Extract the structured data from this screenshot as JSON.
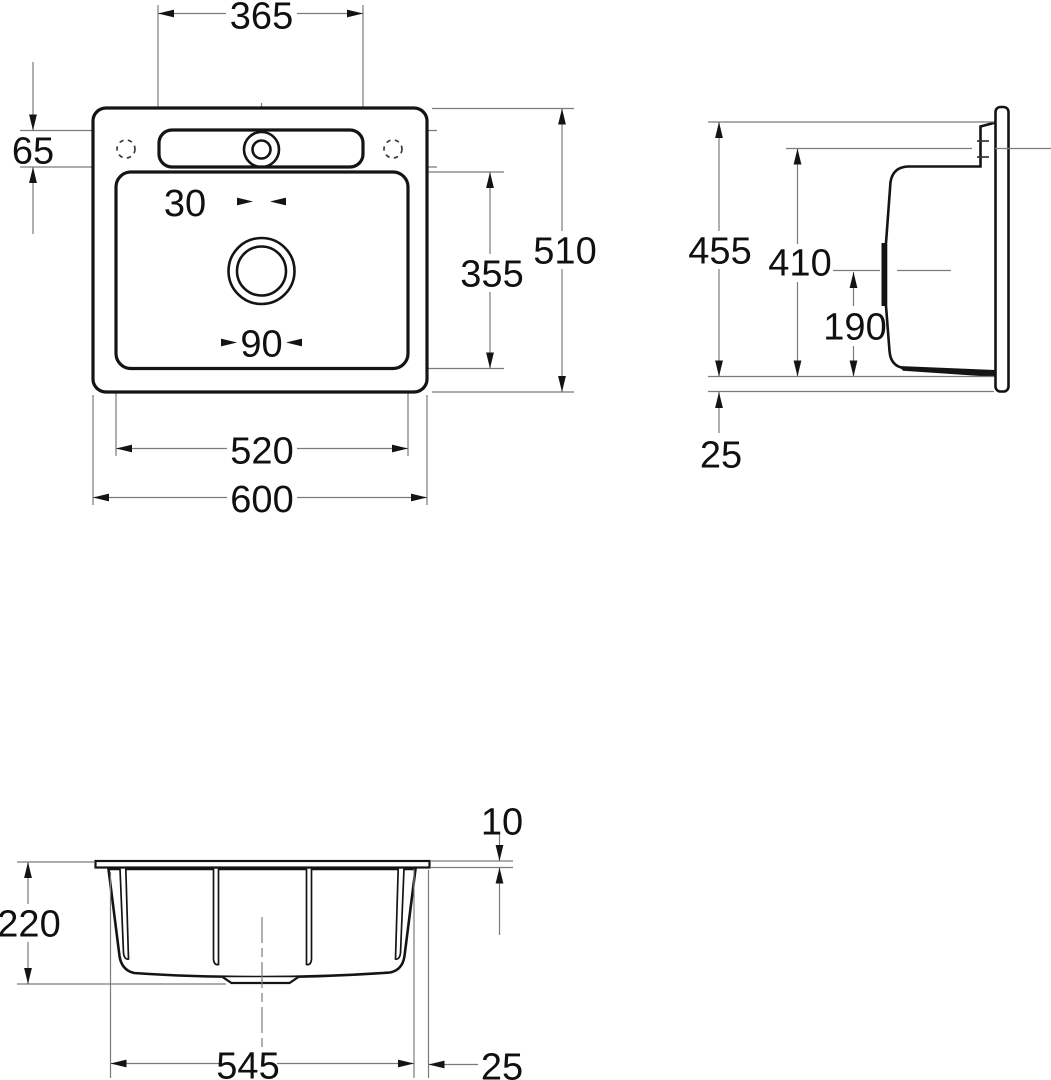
{
  "drawing": {
    "kind": "sink-installation-dimension-drawing",
    "views": {
      "plan": {
        "dims": {
          "deck_cutout_width": "365",
          "deck_depth": "65",
          "tap_hole_diameter": "30",
          "bowl_depth": "355",
          "overall_depth": "510",
          "waste_hole_diameter": "90",
          "bowl_width": "520",
          "overall_width": "600"
        }
      },
      "side": {
        "dims": {
          "overall_height": "455",
          "deck_height": "410",
          "waste_axis_height": "190",
          "flange_bottom_offset": "25"
        }
      },
      "front": {
        "dims": {
          "rim_thickness": "10",
          "body_height": "220",
          "body_width": "545",
          "rim_overhang": "25"
        }
      }
    },
    "colors": {
      "outline": "#141414",
      "dimension_lines": "#7b7b7b",
      "text": "#101010",
      "background": "#ffffff"
    }
  }
}
